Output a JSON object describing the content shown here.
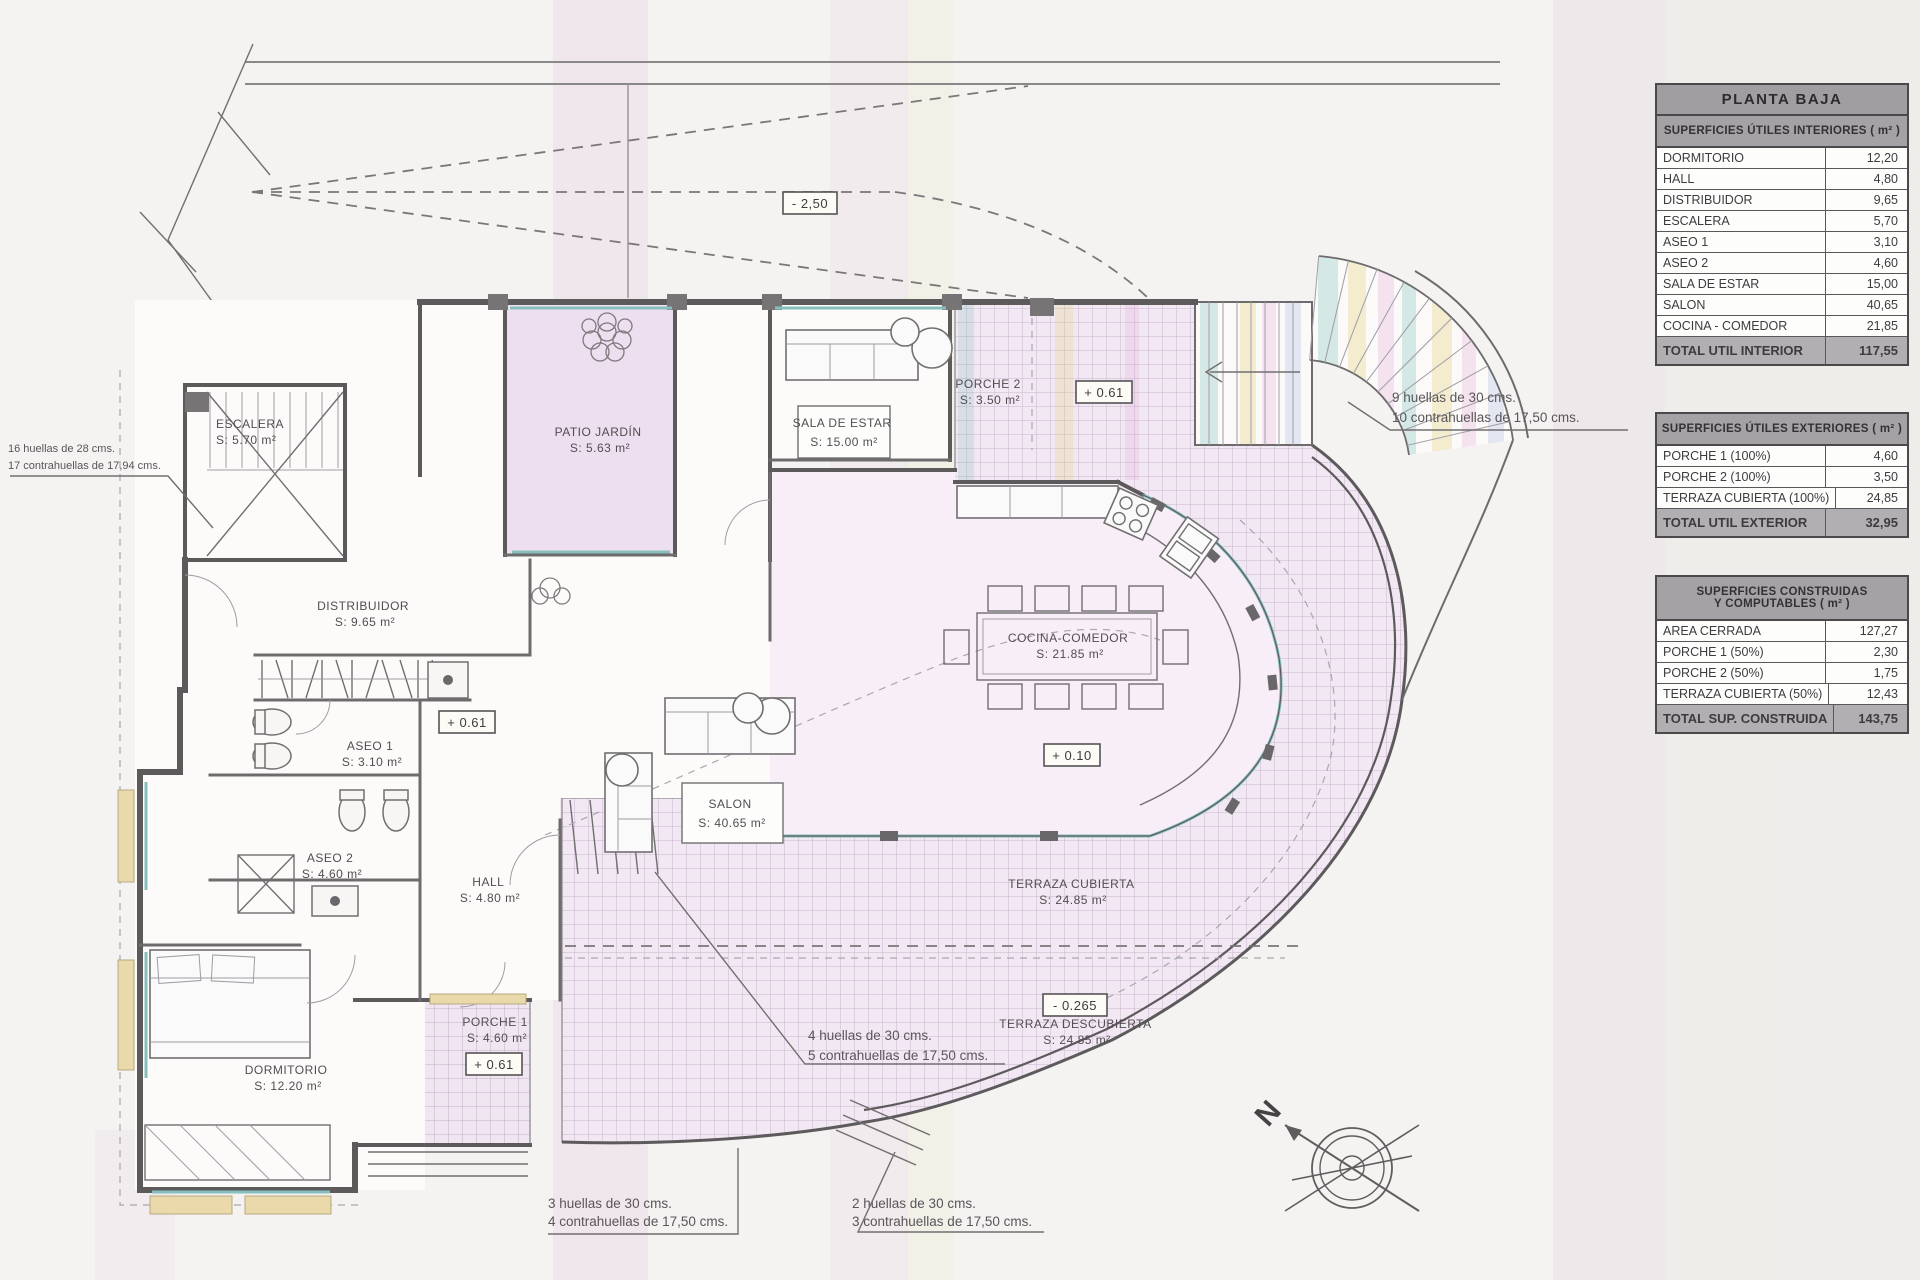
{
  "tables": {
    "planta_baja_title": "PLANTA BAJA",
    "interior": {
      "header": "SUPERFICIES ÚTILES INTERIORES ( m² )",
      "rows": [
        {
          "label": "DORMITORIO",
          "value": "12,20"
        },
        {
          "label": "HALL",
          "value": "4,80"
        },
        {
          "label": "DISTRIBUIDOR",
          "value": "9,65"
        },
        {
          "label": "ESCALERA",
          "value": "5,70"
        },
        {
          "label": "ASEO 1",
          "value": "3,10"
        },
        {
          "label": "ASEO 2",
          "value": "4,60"
        },
        {
          "label": "SALA DE ESTAR",
          "value": "15,00"
        },
        {
          "label": "SALON",
          "value": "40,65"
        },
        {
          "label": "COCINA - COMEDOR",
          "value": "21,85"
        }
      ],
      "total": {
        "label": "TOTAL UTIL INTERIOR",
        "value": "117,55"
      }
    },
    "exterior": {
      "header": "SUPERFICIES ÚTILES EXTERIORES ( m² )",
      "rows": [
        {
          "label": "PORCHE 1 (100%)",
          "value": "4,60"
        },
        {
          "label": "PORCHE 2 (100%)",
          "value": "3,50"
        },
        {
          "label": "TERRAZA CUBIERTA (100%)",
          "value": "24,85"
        }
      ],
      "total": {
        "label": "TOTAL UTIL EXTERIOR",
        "value": "32,95"
      }
    },
    "construidas": {
      "header_line1": "SUPERFICIES CONSTRUIDAS",
      "header_line2": "Y COMPUTABLES ( m² )",
      "rows": [
        {
          "label": "AREA CERRADA",
          "value": "127,27"
        },
        {
          "label": "PORCHE 1 (50%)",
          "value": "2,30"
        },
        {
          "label": "PORCHE 2 (50%)",
          "value": "1,75"
        },
        {
          "label": "TERRAZA CUBIERTA (50%)",
          "value": "12,43"
        }
      ],
      "total": {
        "label": "TOTAL SUP. CONSTRUIDA",
        "value": "143,75"
      }
    }
  },
  "plan": {
    "room_labels": [
      {
        "name": "escalera",
        "lines": [
          "ESCALERA",
          "S: 5.70 m²"
        ]
      },
      {
        "name": "patio-jardin",
        "lines": [
          "PATIO JARDÍN",
          "S: 5.63 m²"
        ]
      },
      {
        "name": "sala-de-estar",
        "lines": [
          "SALA DE ESTAR",
          "S: 15.00 m²"
        ]
      },
      {
        "name": "porche-2",
        "lines": [
          "PORCHE 2",
          "S: 3.50 m²"
        ]
      },
      {
        "name": "distribuidor",
        "lines": [
          "DISTRIBUIDOR",
          "S: 9.65 m²"
        ]
      },
      {
        "name": "aseo-1",
        "lines": [
          "ASEO 1",
          "S: 3.10 m²"
        ]
      },
      {
        "name": "aseo-2",
        "lines": [
          "ASEO 2",
          "S: 4.60 m²"
        ]
      },
      {
        "name": "hall",
        "lines": [
          "HALL",
          "S: 4.80 m²"
        ]
      },
      {
        "name": "salon",
        "lines": [
          "SALON",
          "S: 40.65 m²"
        ]
      },
      {
        "name": "cocina-comedor",
        "lines": [
          "COCINA-COMEDOR",
          "S: 21.85 m²"
        ]
      },
      {
        "name": "terraza-cubierta",
        "lines": [
          "TERRAZA CUBIERTA",
          "S: 24.85 m²"
        ]
      },
      {
        "name": "terraza-descubierta",
        "lines": [
          "TERRAZA DESCUBIERTA",
          "S: 24.85 m²"
        ]
      },
      {
        "name": "porche-1",
        "lines": [
          "PORCHE 1",
          "S: 4.60 m²"
        ]
      },
      {
        "name": "dormitorio",
        "lines": [
          "DORMITORIO",
          "S: 12.20 m²"
        ]
      }
    ],
    "level_markers": [
      {
        "name": "level-ramp",
        "text": "- 2,50"
      },
      {
        "name": "level-porche-2",
        "text": "+ 0.61"
      },
      {
        "name": "level-salon",
        "text": "+ 0.61"
      },
      {
        "name": "level-cocina",
        "text": "+ 0.10"
      },
      {
        "name": "level-terraza",
        "text": "- 0.265"
      },
      {
        "name": "level-porche-1",
        "text": "+ 0.61"
      }
    ],
    "stair_notes": [
      {
        "name": "escalera-interior",
        "lines": [
          "16 huellas de 28 cms.",
          "17 contrahuellas de 17,94 cms."
        ]
      },
      {
        "name": "escalera-exterior-9",
        "lines": [
          "9 huellas de 30 cms.",
          "10 contrahuellas de 17,50 cms."
        ]
      },
      {
        "name": "escalera-terraza-4",
        "lines": [
          "4 huellas de 30 cms.",
          "5 contrahuellas de 17,50 cms."
        ]
      },
      {
        "name": "escalera-porche-3",
        "lines": [
          "3 huellas de 30 cms.",
          "4 contrahuellas de 17,50 cms."
        ]
      },
      {
        "name": "escalera-jardin-2",
        "lines": [
          "2 huellas de 30 cms.",
          "3 contrahuellas de 17,50 cms."
        ]
      }
    ],
    "compass": {
      "label": "N"
    }
  },
  "colors": {
    "paper": "#f4f3f1",
    "table_header": "#a5a2a6",
    "table_total": "#b2afb3",
    "wall": "#5d5a5c",
    "tile_fill": "#f2e8f3",
    "tile_line": "#c9b6cd",
    "patio_fill": "#eedff0",
    "kitchen_fill": "#f7eef7",
    "glass": "#86bfbd",
    "sill": "#ead9ab",
    "stripe_teal": "rgba(110,185,180,0.28)",
    "stripe_yellow": "rgba(225,205,110,0.30)",
    "stripe_pink": "rgba(225,160,210,0.25)"
  }
}
